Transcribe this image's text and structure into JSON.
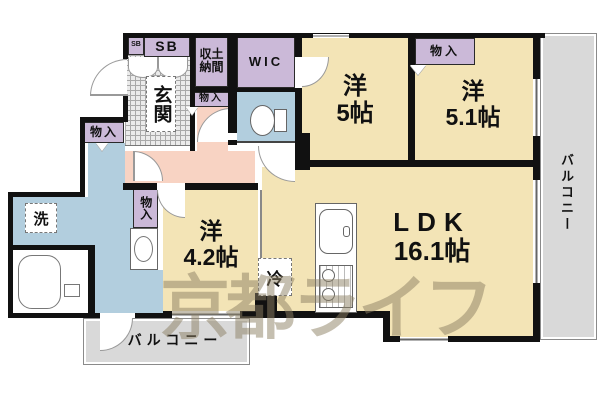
{
  "labels": {
    "sb_small": "SB",
    "sb": "SB",
    "doma_line1": "収土",
    "doma_line2": "納間",
    "wic": "WIC",
    "genkan": "玄関",
    "mono_hall": "物入",
    "mono_top": "物入",
    "mono_left": "物入",
    "mono_mid": "物入",
    "yo5_name": "洋",
    "yo5_size": "5帖",
    "yo51_name": "洋",
    "yo51_size": "5.1帖",
    "yo42_name": "洋",
    "yo42_size": "4.2帖",
    "ldk_name": "LDK",
    "ldk_size": "16.1帖",
    "rei": "冷",
    "sen": "洗",
    "balcony_right": "バルコニー",
    "balcony_bottom": "バルコニー",
    "watermark": "京都ライフ"
  },
  "colors": {
    "wall": "#111111",
    "closet": "#cbb9d8",
    "room": "#f3e4b6",
    "hall": "#f8d3c3",
    "wet": "#b2cede",
    "balcony": "#d9d9d9",
    "watermark": "#8d8064"
  }
}
